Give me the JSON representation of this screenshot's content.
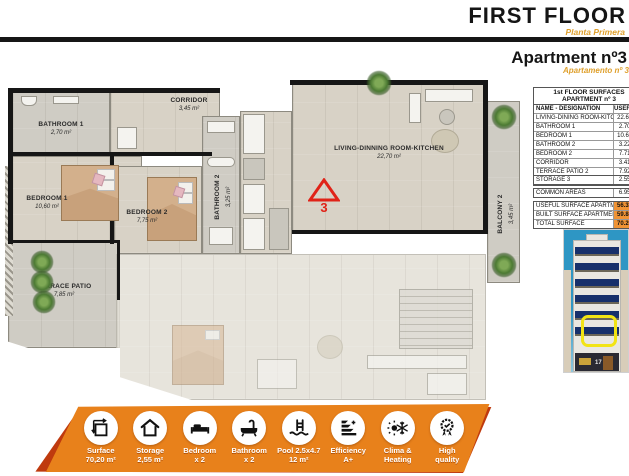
{
  "header": {
    "title": "FIRST FLOOR",
    "subtitle": "Planta Primera"
  },
  "apartment": {
    "title": "Apartment nº3",
    "subtitle": "Apartamento nº 3"
  },
  "marker": {
    "number": "3"
  },
  "plan": {
    "bathroom1": {
      "name": "BATHROOM 1",
      "area": "2,70 m²"
    },
    "bedroom1": {
      "name": "BEDROOM 1",
      "area": "10,60 m²"
    },
    "bedroom2": {
      "name": "BEDROOM 2",
      "area": "7,75 m²"
    },
    "corridor": {
      "name": "CORRIDOR",
      "area": "3,45 m²"
    },
    "bathroom2": {
      "name": "BATHROOM 2",
      "area": "3,25 m²"
    },
    "living": {
      "name": "LIVING-DINNING ROOM-KITCHEN",
      "area": "22,70 m²"
    },
    "balcony": {
      "name": "BALCONY 2",
      "area": "3,45 m²"
    },
    "terrace": {
      "name": "TERRACE PATIO",
      "area": "7,85 m²"
    }
  },
  "surfaces": {
    "title1": "1st FLOOR SURFACES",
    "title2": "APARTMENT nº 3",
    "col_name": "NAME - DESIGNATION",
    "col_value": "USEFUL SURFACE",
    "rooms": [
      {
        "name": "LIVING-DINING ROOM-KITCHEN",
        "value": "22.60 m²"
      },
      {
        "name": "BATHROOM 1",
        "value": "2.70 m²"
      },
      {
        "name": "BEDROOM 1",
        "value": "10.62 m²"
      },
      {
        "name": "BATHROOM 2",
        "value": "3.22 m²"
      },
      {
        "name": "BEDROOM 2",
        "value": "7.71 m²"
      },
      {
        "name": "CORRIDOR",
        "value": "3.41 m²"
      },
      {
        "name": "TERRACE PATIO 2",
        "value": "7.92 m²"
      },
      {
        "name": "BALCONY 2",
        "value": "3.45 m²"
      }
    ],
    "storage": {
      "name": "STORAGE 3",
      "value": "2.55 m²"
    },
    "common": {
      "name": "COMMON AREAS",
      "value": "6.95 m²"
    },
    "summary": [
      {
        "name": "USEFUL SURFACE APARTMENT",
        "value": "56.32 m²"
      },
      {
        "name": "BUILT SURFACE APARTMENT",
        "value": "59.85 m²"
      },
      {
        "name": "TOTAL SURFACE",
        "value": "70.20 m²"
      }
    ]
  },
  "building": {
    "street_number": "17"
  },
  "banner": {
    "items": [
      {
        "icon": "surface-icon",
        "label": "Surface",
        "value": "70,20 m²"
      },
      {
        "icon": "storage-icon",
        "label": "Storage",
        "value": "2,55 m²"
      },
      {
        "icon": "bedroom-icon",
        "label": "Bedroom",
        "value": "x 2"
      },
      {
        "icon": "bathroom-icon",
        "label": "Bathroom",
        "value": "x 2"
      },
      {
        "icon": "pool-icon",
        "label": "Pool 2.5x4.7",
        "value": "12 m²"
      },
      {
        "icon": "efficiency-icon",
        "label": "Efficiency",
        "value": "A+"
      },
      {
        "icon": "climate-icon",
        "label": "Clima &",
        "value": "Heating"
      },
      {
        "icon": "quality-icon",
        "label": "High",
        "value": "quality"
      }
    ]
  },
  "colors": {
    "accent_orange": "#E8811B",
    "banner_shadow": "#BF3A0E",
    "table_highlight": "#F09334",
    "marker_red": "#E02318"
  }
}
